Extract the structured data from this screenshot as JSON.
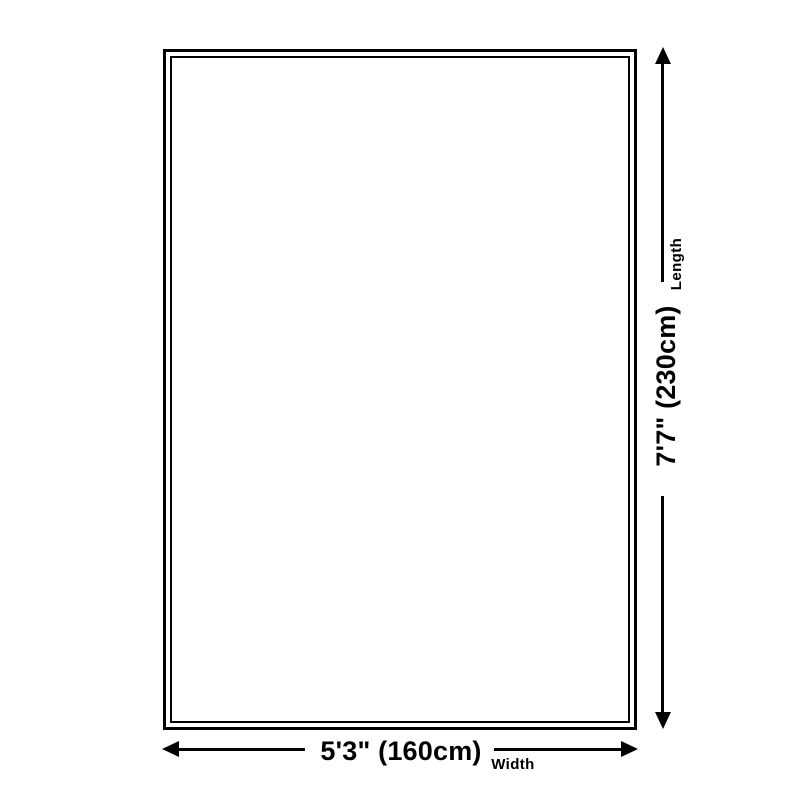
{
  "diagram": {
    "kind": "product-dimension-diagram",
    "background_color": "#ffffff",
    "line_color": "#000000",
    "text_color": "#000000",
    "length": {
      "label": "Length",
      "value": "7'7\" (230cm)"
    },
    "width": {
      "label": "Width",
      "value": "5'3\" (160cm)"
    }
  }
}
